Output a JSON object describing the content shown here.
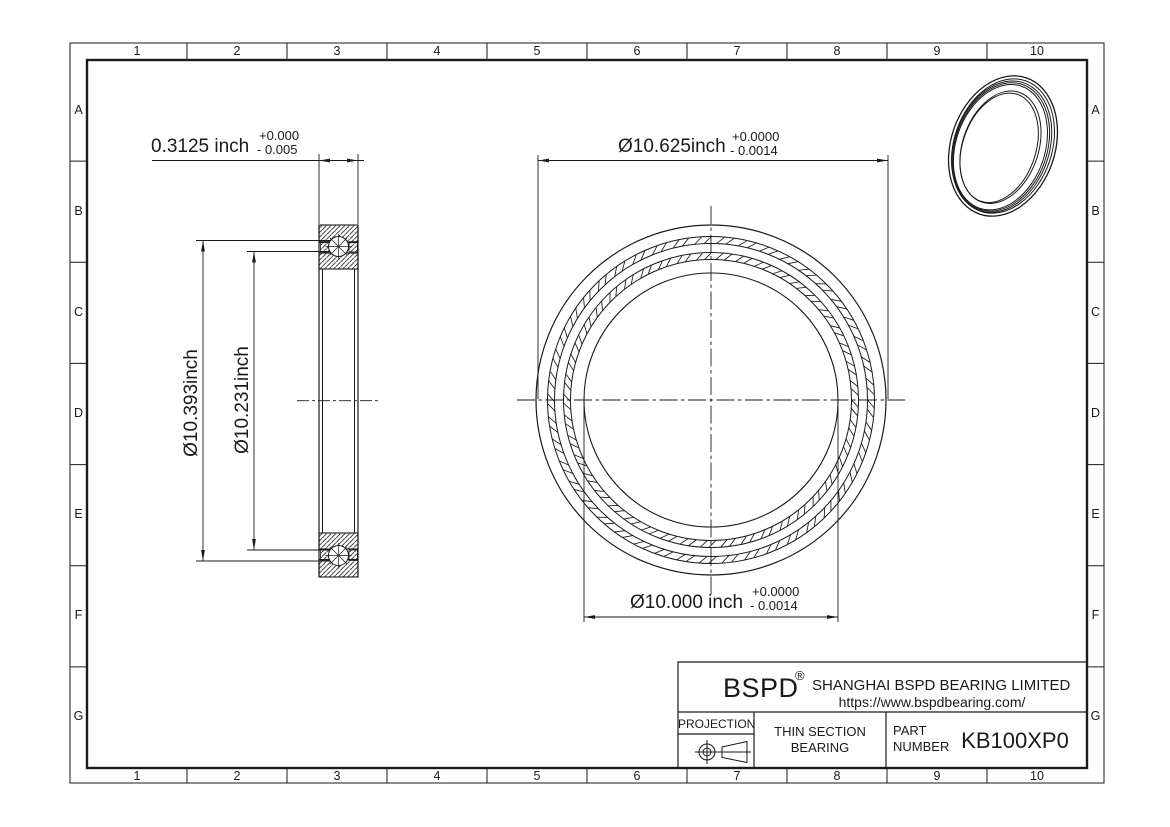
{
  "grid": {
    "columns": [
      "1",
      "2",
      "3",
      "4",
      "5",
      "6",
      "7",
      "8",
      "9",
      "10"
    ],
    "rows": [
      "A",
      "B",
      "C",
      "D",
      "E",
      "F",
      "G"
    ]
  },
  "views": {
    "side_view": {
      "width_dim": {
        "value": "0.3125 inch",
        "tol_plus": "+0.000",
        "tol_minus": "- 0.005"
      },
      "outer_race_dim": {
        "value": "Ø10.393inch"
      },
      "inner_race_dim": {
        "value": "Ø10.231inch"
      }
    },
    "front_view": {
      "outer_dia_dim": {
        "value": "Ø10.625inch",
        "tol_plus": "+0.0000",
        "tol_minus": "- 0.0014"
      },
      "bore_dia_dim": {
        "value": "Ø10.000 inch",
        "tol_plus": "+0.0000",
        "tol_minus": "- 0.0014"
      }
    }
  },
  "title_block": {
    "logo": "BSPD",
    "registered_mark": "®",
    "company_name": "SHANGHAI BSPD BEARING LIMITED",
    "website": "https://www.bspdbearing.com/",
    "projection_label": "PROJECTION",
    "product_type_line1": "THIN SECTION",
    "product_type_line2": "BEARING",
    "part_number_label_line1": "PART",
    "part_number_label_line2": "NUMBER",
    "part_number": "KB100XP0"
  },
  "colors": {
    "line": "#1a1a1a",
    "background": "#ffffff"
  }
}
